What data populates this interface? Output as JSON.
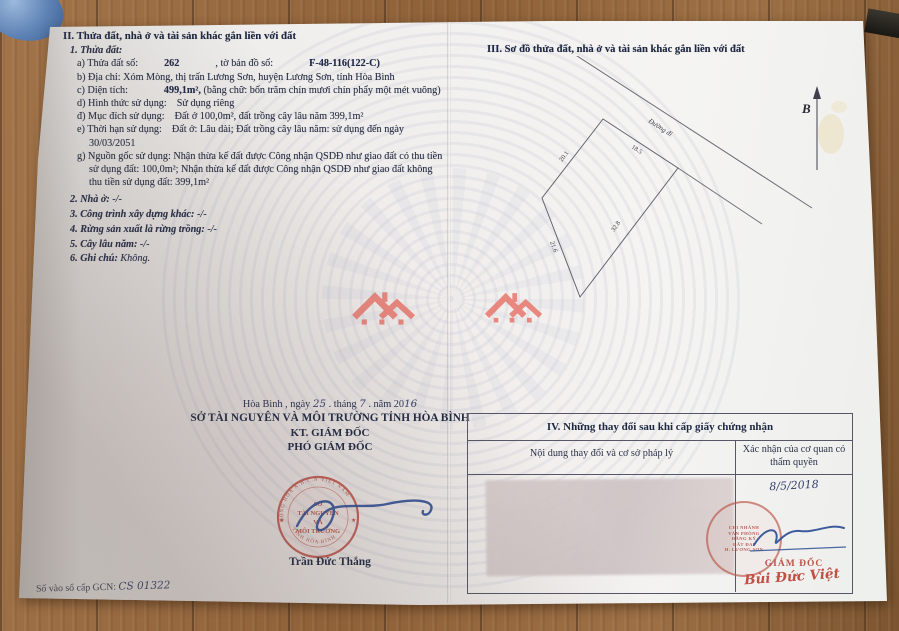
{
  "document": {
    "section2": {
      "heading": "II. Thửa đất, nhà ở và tài sản khác gắn liền với đất",
      "sub1": "1. Thửa đất:",
      "a_label": "a) Thửa đất số:",
      "a_value": "262",
      "a_label2": ", tờ bản đồ số:",
      "a_value2": "F-48-116(122-C)",
      "b": "b) Địa chỉ: Xóm Mòng, thị trấn Lương Sơn, huyện Lương Sơn, tỉnh Hòa Bình",
      "c_label": "c) Diện tích:",
      "c_value": "499,1m²,",
      "c_words": "(bằng chữ: bốn trăm chín mươi chín phẩy một mét vuông)",
      "d_label": "d) Hình thức sử dụng:",
      "d_value": "Sử dụng riêng",
      "dd_label": "đ) Mục đích sử dụng:",
      "dd_value": "Đất ở 100,0m², đất trồng cây lâu năm 399,1m²",
      "e_label": "e) Thời hạn sử dụng:",
      "e_value": "Đất ở: Lâu dài; Đất trồng cây lâu năm: sử dụng đến ngày",
      "e_value2": "30/03/2051",
      "g_line1": "g) Nguồn gốc sử dụng: Nhận thừa kế đất được Công nhận QSDĐ như giao đất có thu tiền",
      "g_line2": "sử dụng đất: 100,0m²; Nhận thừa kế đất được Công nhận QSDĐ như giao đất không",
      "g_line3": "thu tiền sử dụng đất: 399,1m²",
      "item2_label": "2. Nhà ở:",
      "item2_value": "-/-",
      "item3_label": "3. Công trình xây dựng khác:",
      "item3_value": "-/-",
      "item4_label": "4. Rừng sản xuất là rừng trồng:",
      "item4_value": "-/-",
      "item5_label": "5. Cây lâu năm:",
      "item5_value": "-/-",
      "item6_label": "6. Ghi chú:",
      "item6_value": "Không."
    },
    "section3": {
      "heading": "III. Sơ đồ thửa đất, nhà ở và tài sản khác gắn liền với đất",
      "diagram": {
        "edge_top_left": "20.1",
        "edge_top": "18.5",
        "edge_left": "21.6",
        "edge_right": "32.8",
        "road_label": "Đường đi",
        "north_label": "B"
      }
    },
    "sign_left": {
      "date_prefix": "Hòa Bình , ngày",
      "day": "25",
      "date_mid1": ". tháng",
      "month": "7",
      "date_mid2": ". năm 20",
      "year": "16",
      "org": "SỞ TÀI NGUYÊN VÀ MÔI TRƯỜNG TỈNH HÒA BÌNH",
      "kt": "KT. GIÁM ĐỐC",
      "deputy": "PHÓ GIÁM ĐỐC",
      "signer": "Trần Đức Thắng",
      "seal": {
        "arc_top": "CỘNG HÒA X.H.C.N VIỆT NAM",
        "line1": "SỞ",
        "line2": "TÀI NGUYÊN",
        "line3": "VÀ",
        "line4": "MÔI TRƯỜNG",
        "arc_bottom": "TỈNH HÒA BÌNH"
      }
    },
    "section4": {
      "title": "IV. Những thay đổi sau khi cấp giấy chứng nhận",
      "col1": "Nội dung thay đổi và cơ sở pháp lý",
      "col2": "Xác nhận của cơ quan có thẩm quyền",
      "entry_date": "8/5/2018",
      "seal_lines": [
        "CHI NHÁNH",
        "VĂN PHÒNG",
        "ĐĂNG KÝ",
        "ĐẤT ĐAI",
        "H. LƯƠNG SƠN"
      ],
      "approver_title": "GIÁM ĐỐC",
      "approver_name": "Bùi Đức Việt"
    },
    "footer": {
      "gcn_label": "Số vào sổ cấp GCN:",
      "gcn_value": "CS 01322"
    }
  },
  "colors": {
    "seal_red": "#c0544a",
    "ink_blue": "#2f4f96",
    "logo_salmon": "#e87a70",
    "print_navy": "#2b3248"
  }
}
